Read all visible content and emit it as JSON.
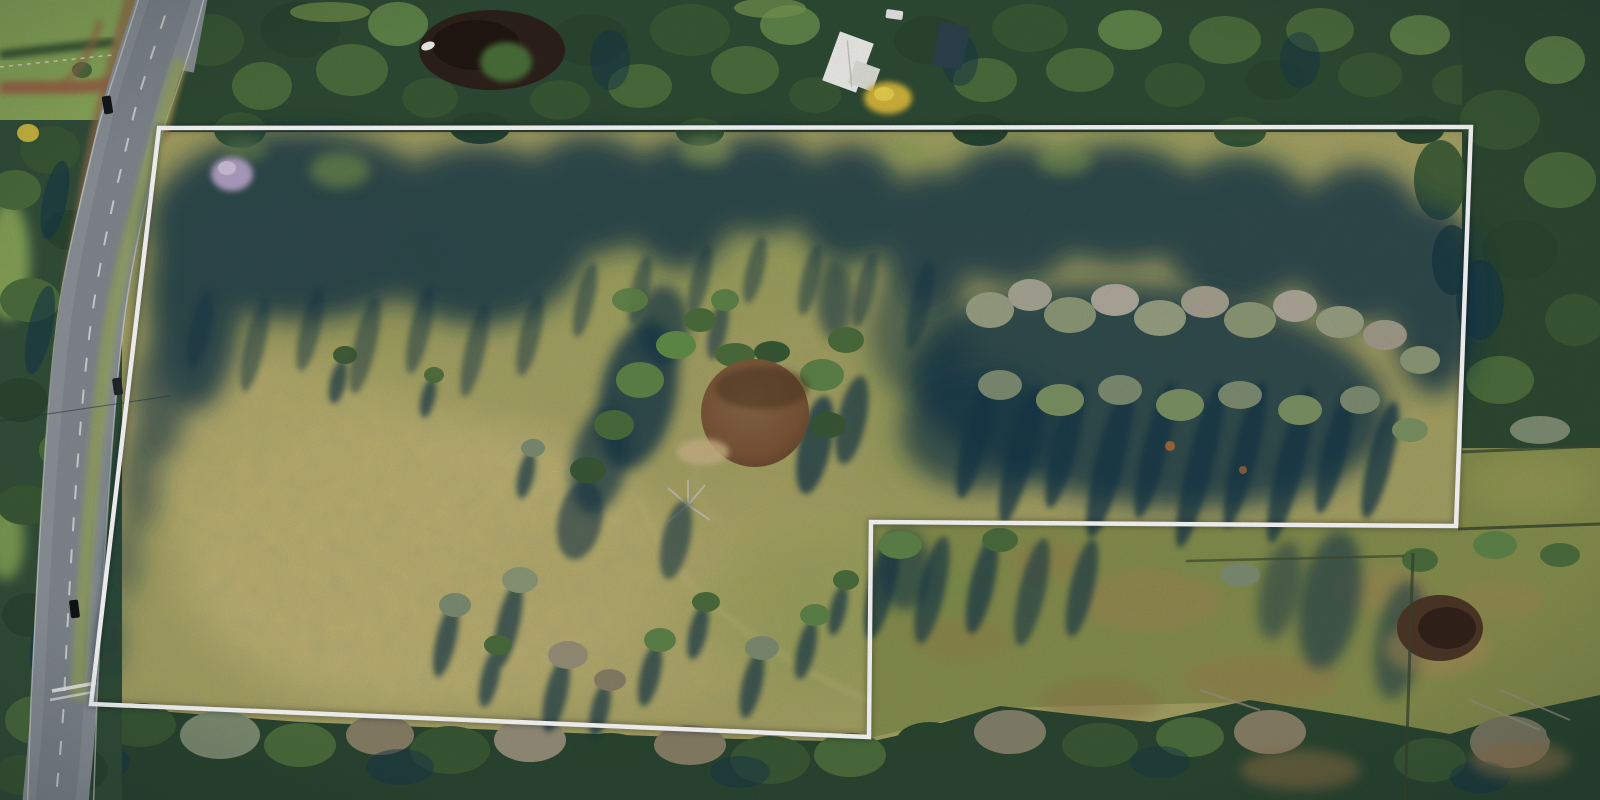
{
  "scene": {
    "description": "Aerial drone photograph of a large rural acreage for sale: open olive-green paddock outlined with a white property-boundary overlay, bordered by a curving country road on the left, dense tree belts top and bottom, a farm dam in the centre, a neighbouring fenced paddock cut out of the bottom-right corner",
    "style": "real-estate aerial photo, late-afternoon sun with long tree shadows falling down-left"
  },
  "boundary": {
    "shape": "closed L-shaped parcel, bottom-right notch excluded",
    "points_str": "159,128 1471,127 1456,526 871,522 869,737 91,704",
    "points": [
      [
        159,
        128
      ],
      [
        1471,
        127
      ],
      [
        1456,
        526
      ],
      [
        871,
        522
      ],
      [
        869,
        737
      ],
      [
        91,
        704
      ]
    ],
    "stroke": "#ffffff",
    "stroke_width": 4.5
  },
  "palette": {
    "field_base": "#a9a463",
    "field_light": "#c8ba79",
    "field_green": "#93a054",
    "forest_dark": "#2e4a33",
    "forest_mid": "#4c6f3e",
    "canopy_grey": "#a8a392",
    "shadow_teal": "#16384a",
    "road_grey": "#8e959b",
    "shoulder_brown": "#9a6a49",
    "dirt_track": "#a06b48",
    "dam_brown": "#7b5638",
    "top_pond_dark": "#2e211b",
    "small_pond": "#4e3827",
    "neighbor_field": "#87904f",
    "neighbor_brown": "#a08756",
    "house_roof": "#f1f1ee",
    "shed_roof": "#2d4350",
    "yellow_tree": "#d6b83c",
    "lavender_tree": "#b2a3c6",
    "boundary_white": "#ffffff"
  },
  "features": {
    "road": "sealed two-lane road curving along the left boundary, white centre dashes, brown gravel shoulders near the top, pedestrian-crossing marks near the bottom",
    "ponds": "dark tree-ringed pond at top centre-left with small white boat; brown farm dam in centre of paddock; small brown dam in neighbouring paddock at right",
    "house": "white-roofed house with dark shed and yellow flowering tree among trees at top centre-right",
    "cars": "three dark cars travelling on the road, one white car parked near the house"
  },
  "shapes": [
    {
      "tag": "ellipse",
      "group": "g-ponds",
      "name": "top-pond-water",
      "attrs": {
        "cx": 492,
        "cy": 50,
        "rx": 73,
        "ry": 40,
        "fill": "#2e211b"
      }
    },
    {
      "tag": "ellipse",
      "group": "g-ponds",
      "name": "top-pond-deep",
      "attrs": {
        "cx": 476,
        "cy": 45,
        "rx": 44,
        "ry": 25,
        "fill": "#1f1511",
        "opacity": "0.85"
      }
    },
    {
      "tag": "ellipse",
      "group": "g-ponds",
      "name": "top-pond-tree-clump",
      "attrs": {
        "cx": 506,
        "cy": 62,
        "rx": 26,
        "ry": 20,
        "fill": "#4e763c",
        "opacity": "0.95",
        "filter": "url(#b3)"
      }
    },
    {
      "tag": "ellipse",
      "group": "g-ponds",
      "name": "boat",
      "attrs": {
        "cx": 428,
        "cy": 46,
        "rx": 7,
        "ry": 4,
        "fill": "#f5f5f0",
        "transform": "rotate(-20 428 46)"
      }
    },
    {
      "tag": "ellipse",
      "group": "g-ponds",
      "name": "dam-pond-water",
      "attrs": {
        "cx": 755,
        "cy": 413,
        "rx": 54,
        "ry": 54,
        "fill": "url(#pondGrad)"
      }
    },
    {
      "tag": "ellipse",
      "group": "g-ponds",
      "name": "dam-pond-shade",
      "attrs": {
        "cx": 762,
        "cy": 388,
        "rx": 47,
        "ry": 21,
        "fill": "#503823",
        "opacity": "0.55",
        "filter": "url(#b3)"
      }
    },
    {
      "tag": "ellipse",
      "group": "g-ponds",
      "name": "dam-pond-sandy-bank",
      "attrs": {
        "cx": 703,
        "cy": 452,
        "rx": 26,
        "ry": 13,
        "fill": "#ccb687",
        "opacity": "0.85",
        "filter": "url(#b3)"
      }
    },
    {
      "tag": "ellipse",
      "group": "g-ponds",
      "name": "small-pond-rim",
      "attrs": {
        "cx": 1438,
        "cy": 648,
        "rx": 54,
        "ry": 28,
        "fill": "#a98c58",
        "opacity": "0.55",
        "filter": "url(#b6)"
      }
    },
    {
      "tag": "ellipse",
      "group": "g-ponds",
      "name": "small-pond-water",
      "attrs": {
        "cx": 1440,
        "cy": 628,
        "rx": 43,
        "ry": 33,
        "fill": "#4e3827"
      }
    },
    {
      "tag": "ellipse",
      "group": "g-ponds",
      "name": "small-pond-deep",
      "attrs": {
        "cx": 1447,
        "cy": 628,
        "rx": 29,
        "ry": 21,
        "fill": "#33231c"
      }
    },
    {
      "tag": "rect",
      "group": "g-house",
      "name": "house-roof-main",
      "attrs": {
        "x": 830,
        "y": 36,
        "width": 36,
        "height": 52,
        "fill": "#f1f1ee",
        "transform": "rotate(20 848 62)"
      }
    },
    {
      "tag": "rect",
      "group": "g-house",
      "name": "house-roof-wing",
      "attrs": {
        "x": 851,
        "y": 64,
        "width": 26,
        "height": 24,
        "fill": "#e2e2dc",
        "transform": "rotate(20 864 76)"
      }
    },
    {
      "tag": "line",
      "group": "g-house",
      "name": "house-roof-ridge",
      "attrs": {
        "x1": 840,
        "y1": 42,
        "x2": 860,
        "y2": 84,
        "stroke": "#c9c9c2",
        "stroke-width": "1.5",
        "transform": "rotate(20 848 62)"
      }
    },
    {
      "tag": "rect",
      "group": "g-house",
      "name": "shed-roof",
      "attrs": {
        "x": 936,
        "y": 24,
        "width": 30,
        "height": 44,
        "fill": "#2d4350",
        "opacity": "0.95",
        "transform": "rotate(12 951 46)"
      }
    },
    {
      "tag": "ellipse",
      "group": "g-house",
      "name": "yellow-flowering-tree",
      "attrs": {
        "cx": 888,
        "cy": 98,
        "rx": 24,
        "ry": 16,
        "fill": "#d6b83c",
        "filter": "url(#b3)"
      }
    },
    {
      "tag": "ellipse",
      "group": "g-house",
      "name": "yellow-tree-highlight",
      "attrs": {
        "cx": 884,
        "cy": 94,
        "rx": 10,
        "ry": 7,
        "fill": "#ecd34f"
      }
    },
    {
      "tag": "rect",
      "group": "g-house",
      "name": "white-car-driveway",
      "attrs": {
        "x": 886,
        "y": 10,
        "width": 17,
        "height": 9,
        "rx": 2,
        "fill": "#e9eaea",
        "transform": "rotate(8 894 14)"
      }
    },
    {
      "tag": "ellipse",
      "group": "g-trees-special",
      "name": "lavender-flowering-tree",
      "attrs": {
        "cx": 232,
        "cy": 174,
        "rx": 21,
        "ry": 17,
        "fill": "#b2a3c6",
        "filter": "url(#b3)"
      }
    },
    {
      "tag": "ellipse",
      "group": "g-trees-special",
      "name": "lavender-tree-highlight",
      "attrs": {
        "cx": 227,
        "cy": 168,
        "rx": 9,
        "ry": 7,
        "fill": "#d3c8e0",
        "opacity": "0.9"
      }
    },
    {
      "tag": "rect",
      "group": "g-cars",
      "name": "car-north",
      "attrs": {
        "x": 103,
        "y": 96,
        "width": 9,
        "height": 18,
        "rx": 2,
        "fill": "#15181b",
        "transform": "rotate(-9 107 105)"
      }
    },
    {
      "tag": "rect",
      "group": "g-cars",
      "name": "car-middle",
      "attrs": {
        "x": 113,
        "y": 378,
        "width": 9,
        "height": 17,
        "rx": 2,
        "fill": "#23272c",
        "transform": "rotate(-8 117 386)"
      }
    },
    {
      "tag": "rect",
      "group": "g-cars",
      "name": "car-south",
      "attrs": {
        "x": 70,
        "y": 600,
        "width": 9,
        "height": 18,
        "rx": 2,
        "fill": "#111417",
        "transform": "rotate(-7 74 609)"
      }
    },
    {
      "tag": "line",
      "group": "g-fences",
      "name": "fence-east-upper",
      "attrs": {
        "x1": 1462,
        "y1": 452,
        "x2": 1600,
        "y2": 446,
        "stroke": "#3c4a33",
        "stroke-width": "3",
        "opacity": "0.8"
      }
    },
    {
      "tag": "line",
      "group": "g-fences",
      "name": "fence-east-lower",
      "attrs": {
        "x1": 1458,
        "y1": 529,
        "x2": 1600,
        "y2": 524,
        "stroke": "#37452f",
        "stroke-width": "3",
        "opacity": "0.8"
      }
    },
    {
      "tag": "line",
      "group": "g-fences",
      "name": "fence-paddock-vertical",
      "attrs": {
        "x1": 1413,
        "y1": 553,
        "x2": 1405,
        "y2": 800,
        "stroke": "#3a4430",
        "stroke-width": "3",
        "opacity": "0.75"
      }
    },
    {
      "tag": "line",
      "group": "g-fences",
      "name": "fence-paddock-horizontal",
      "attrs": {
        "x1": 1186,
        "y1": 561,
        "x2": 1404,
        "y2": 556,
        "stroke": "#414d36",
        "stroke-width": "2.5",
        "opacity": "0.7"
      }
    },
    {
      "tag": "line",
      "group": "g-road-marks",
      "name": "crossing-stripe-1",
      "attrs": {
        "x1": 52,
        "y1": 691,
        "x2": 96,
        "y2": 683,
        "stroke": "#f2f2ef",
        "stroke-width": "3.5",
        "opacity": "0.95"
      }
    },
    {
      "tag": "line",
      "group": "g-road-marks",
      "name": "crossing-stripe-2",
      "attrs": {
        "x1": 50,
        "y1": 700,
        "x2": 93,
        "y2": 692,
        "stroke": "#e8e8e4",
        "stroke-width": "2.5",
        "opacity": "0.8"
      }
    },
    {
      "tag": "line",
      "group": "g-road-marks",
      "name": "power-line",
      "attrs": {
        "x1": 0,
        "y1": 421,
        "x2": 170,
        "y2": 396,
        "stroke": "#2c3940",
        "stroke-width": "1.2",
        "opacity": "0.55"
      }
    },
    {
      "tag": "line",
      "group": "g-road-marks",
      "name": "farm-fence-top-left",
      "attrs": {
        "x1": 0,
        "y1": 67,
        "x2": 112,
        "y2": 55,
        "stroke": "#eceade",
        "stroke-width": "1.5",
        "opacity": "0.8",
        "stroke-dasharray": "4 5"
      }
    }
  ]
}
